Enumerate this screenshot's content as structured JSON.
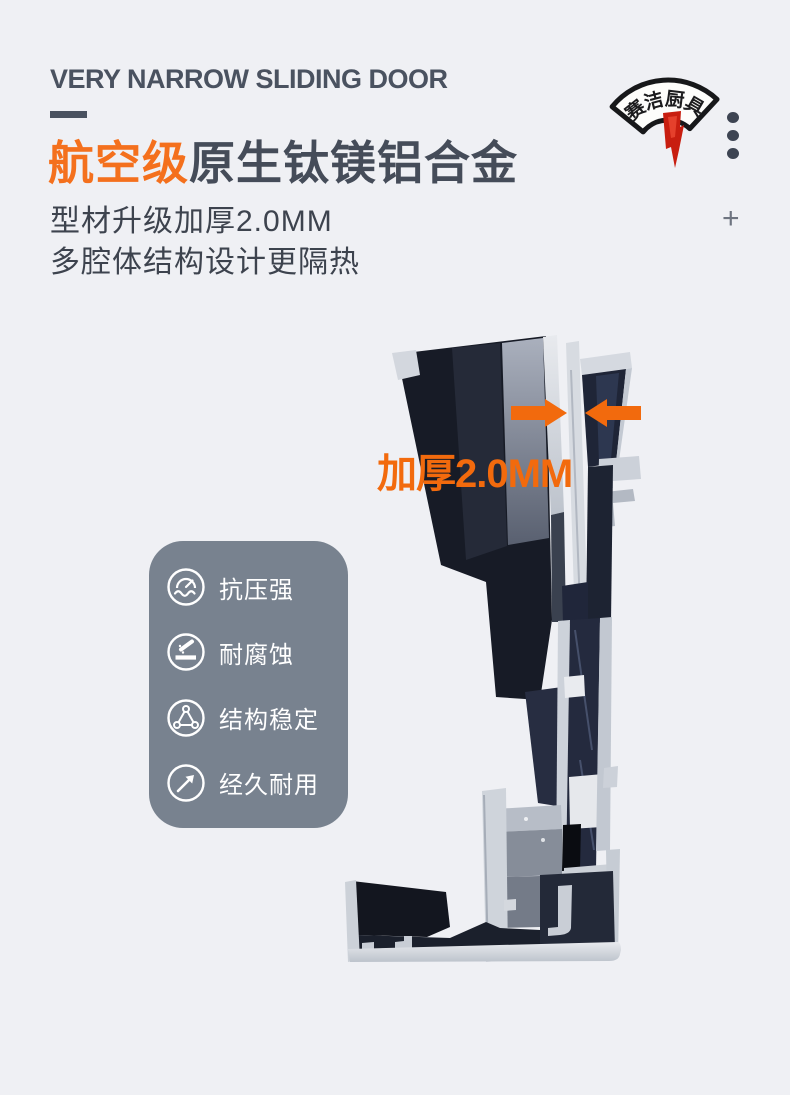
{
  "page": {
    "background": "#eff0f4",
    "width": 790,
    "height": 1095
  },
  "header": {
    "tagline": "VERY NARROW SLIDING DOOR",
    "title": {
      "highlight": "航空级",
      "rest": "原生钛镁铝合金"
    },
    "subtitles": [
      "型材升级加厚2.0MM",
      "多腔体结构设计更隔热"
    ],
    "colors": {
      "accent": "#f4701d",
      "heading": "#454c59",
      "body": "#3d434e"
    }
  },
  "brand": {
    "logo_text": "赛洁厨具",
    "logo_chars": [
      "赛",
      "洁",
      "厨",
      "具"
    ],
    "stamp_color": "#c81e10"
  },
  "decor": {
    "dots": 3,
    "plus_glyph": "+"
  },
  "photo": {
    "annotation": {
      "label": "加厚2.0MM",
      "color": "#f26a0d"
    }
  },
  "features": {
    "card_color": "#78828f",
    "items": [
      {
        "icon": "pressure-gauge-icon",
        "label": "抗压强"
      },
      {
        "icon": "corrosion-resistance-icon",
        "label": "耐腐蚀"
      },
      {
        "icon": "stable-structure-icon",
        "label": "结构稳定"
      },
      {
        "icon": "durability-arrow-icon",
        "label": "经久耐用"
      }
    ]
  }
}
